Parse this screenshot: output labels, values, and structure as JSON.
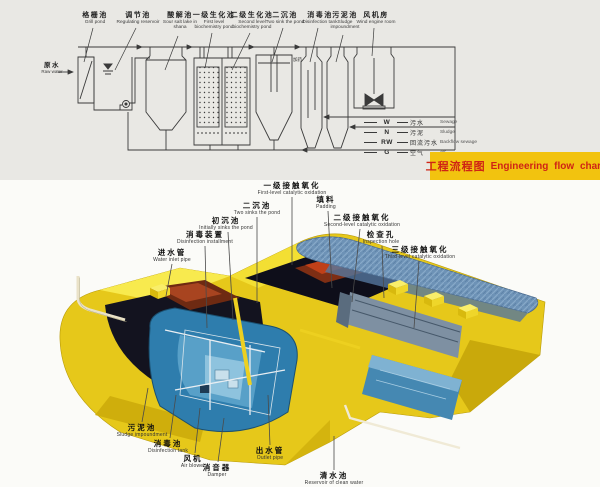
{
  "top_chart": {
    "raw_water": {
      "zh": "原水",
      "en": "Raw water"
    },
    "vessels": [
      {
        "zh": "格栅池",
        "en": "Grill pond"
      },
      {
        "zh": "调节池",
        "en": "Regulating reservoir"
      },
      {
        "zh": "酸解池",
        "en": "Sour salt lake in shana"
      },
      {
        "zh": "一级生化池",
        "en": "First level biochemistry pond"
      },
      {
        "zh": "二级生化池",
        "en": "Second level biochemistry pond"
      },
      {
        "zh": "二沉池",
        "en": "Two sink the pond"
      },
      {
        "zh": "消毒池",
        "en": "Disinfection tank"
      },
      {
        "zh": "污泥池",
        "en": "Sludge impoundment"
      },
      {
        "zh": "风机房",
        "en": "Wind engine room"
      }
    ],
    "dosing_label": {
      "zh": "加药"
    },
    "legend": [
      {
        "symbol": "W",
        "zh": "污水",
        "en": "Sewage"
      },
      {
        "symbol": "N",
        "zh": "污泥",
        "en": "Sludge"
      },
      {
        "symbol": "RW",
        "zh": "回流污水",
        "en": "Backflow sewage"
      },
      {
        "symbol": "G",
        "zh": "空气",
        "en": "Air"
      }
    ],
    "title": {
      "zh": "工程流程图",
      "en": "Engineering flow chart"
    }
  },
  "bottom_diagram": {
    "labels": [
      {
        "zh": "一级接触氧化",
        "en": "First-level catalytic oxidation"
      },
      {
        "zh": "填料",
        "en": "Padding"
      },
      {
        "zh": "二沉池",
        "en": "Two sinks the pond"
      },
      {
        "zh": "初沉池",
        "en": "Initially sinks the pond"
      },
      {
        "zh": "二级接触氧化",
        "en": "Second-level catalytic oxidation"
      },
      {
        "zh": "消毒装置",
        "en": "Disinfection installment"
      },
      {
        "zh": "检查孔",
        "en": "Inspection hole"
      },
      {
        "zh": "进水管",
        "en": "Water inlet pipe"
      },
      {
        "zh": "三级接触氧化",
        "en": "Third-level catalytic oxidation"
      },
      {
        "zh": "污泥池",
        "en": "Sludge impoundment"
      },
      {
        "zh": "消毒池",
        "en": "Disinfection tank"
      },
      {
        "zh": "风机",
        "en": "Air blower"
      },
      {
        "zh": "消音器",
        "en": "Damper"
      },
      {
        "zh": "出水管",
        "en": "Outlet pipe"
      },
      {
        "zh": "清水池",
        "en": "Reservoir of clean water"
      }
    ]
  },
  "colors": {
    "panel_gray": "#e9e8e4",
    "title_bg": "#f2c30f",
    "title_text": "#cf2415",
    "machine_yellow": "#e6c81a",
    "water_blue": "#2e7dad",
    "ink": "#3a3a3a"
  }
}
